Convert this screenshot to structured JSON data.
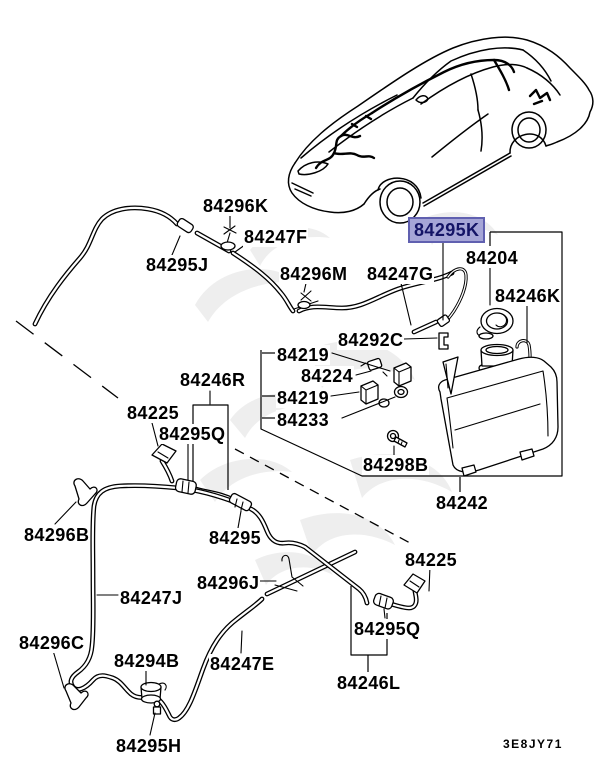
{
  "diagram": {
    "code": "3E8JY71",
    "highlighted_part": "84295K",
    "colors": {
      "line": "#000000",
      "background": "#ffffff",
      "highlight_bg": "#a6a6d7",
      "highlight_border": "#6060b0",
      "highlight_text": "#141466",
      "watermark": "#e2e2e2"
    }
  },
  "labels": [
    {
      "text": "84296K"
    },
    {
      "text": "84247F"
    },
    {
      "text": "84295J"
    },
    {
      "text": "84296M"
    },
    {
      "text": "84247G"
    },
    {
      "text": "84295K",
      "highlighted": true
    },
    {
      "text": "84204"
    },
    {
      "text": "84246K"
    },
    {
      "text": "84292C"
    },
    {
      "text": "84219"
    },
    {
      "text": "84224"
    },
    {
      "text": "84219"
    },
    {
      "text": "84233"
    },
    {
      "text": "84246R"
    },
    {
      "text": "84225"
    },
    {
      "text": "84295Q"
    },
    {
      "text": "84298B"
    },
    {
      "text": "84242"
    },
    {
      "text": "84295"
    },
    {
      "text": "84296B"
    },
    {
      "text": "84296J"
    },
    {
      "text": "84247J"
    },
    {
      "text": "84225"
    },
    {
      "text": "84295Q"
    },
    {
      "text": "84296C"
    },
    {
      "text": "84294B"
    },
    {
      "text": "84247E"
    },
    {
      "text": "84246L"
    },
    {
      "text": "84295H"
    }
  ]
}
